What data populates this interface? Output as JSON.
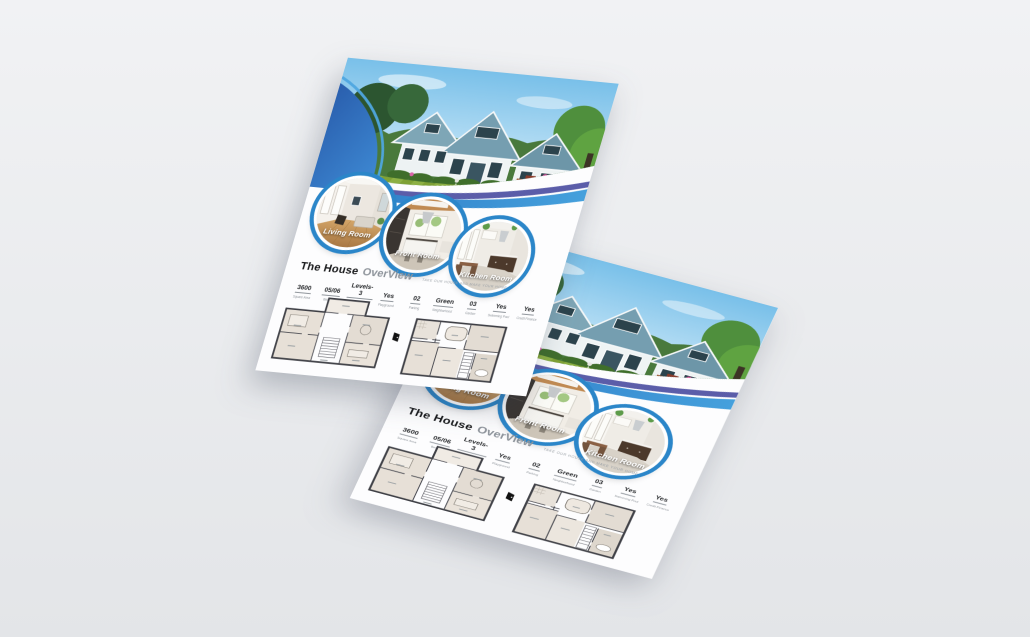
{
  "colors": {
    "bg-top": "#f1f2f4",
    "bg-bottom": "#e3e5e8",
    "paper": "#fdfdfe",
    "ring": "#2b86c9",
    "wave-blue": "#2f7dc8",
    "wave-light": "#4aa0dc",
    "wave-purple": "#5b5da9",
    "sky": "#87c7ec",
    "lawn": "#83a438",
    "title": "#17181a",
    "muted": "#8d939a"
  },
  "flyer": {
    "title_bold": "The House",
    "title_light": "OverView",
    "tagline": "TAKE OUR HOUSE AND MAKE YOUR HOME",
    "circles": [
      {
        "label": "Living Room"
      },
      {
        "label": "Front Room"
      },
      {
        "label": "Kitchen Room"
      }
    ],
    "stats": [
      {
        "value": "3600",
        "label": "Square Area"
      },
      {
        "value": "05/06",
        "label": "Bed Bath"
      },
      {
        "value": "Levels-3",
        "label": "Apartments"
      },
      {
        "value": "Yes",
        "label": "Playground"
      },
      {
        "value": "02",
        "label": "Parking"
      },
      {
        "value": "Green",
        "label": "Neighborhood"
      },
      {
        "value": "03",
        "label": "Garden"
      },
      {
        "value": "Yes",
        "label": "Swimming Pool"
      },
      {
        "value": "Yes",
        "label": "Credit Finance"
      }
    ]
  }
}
